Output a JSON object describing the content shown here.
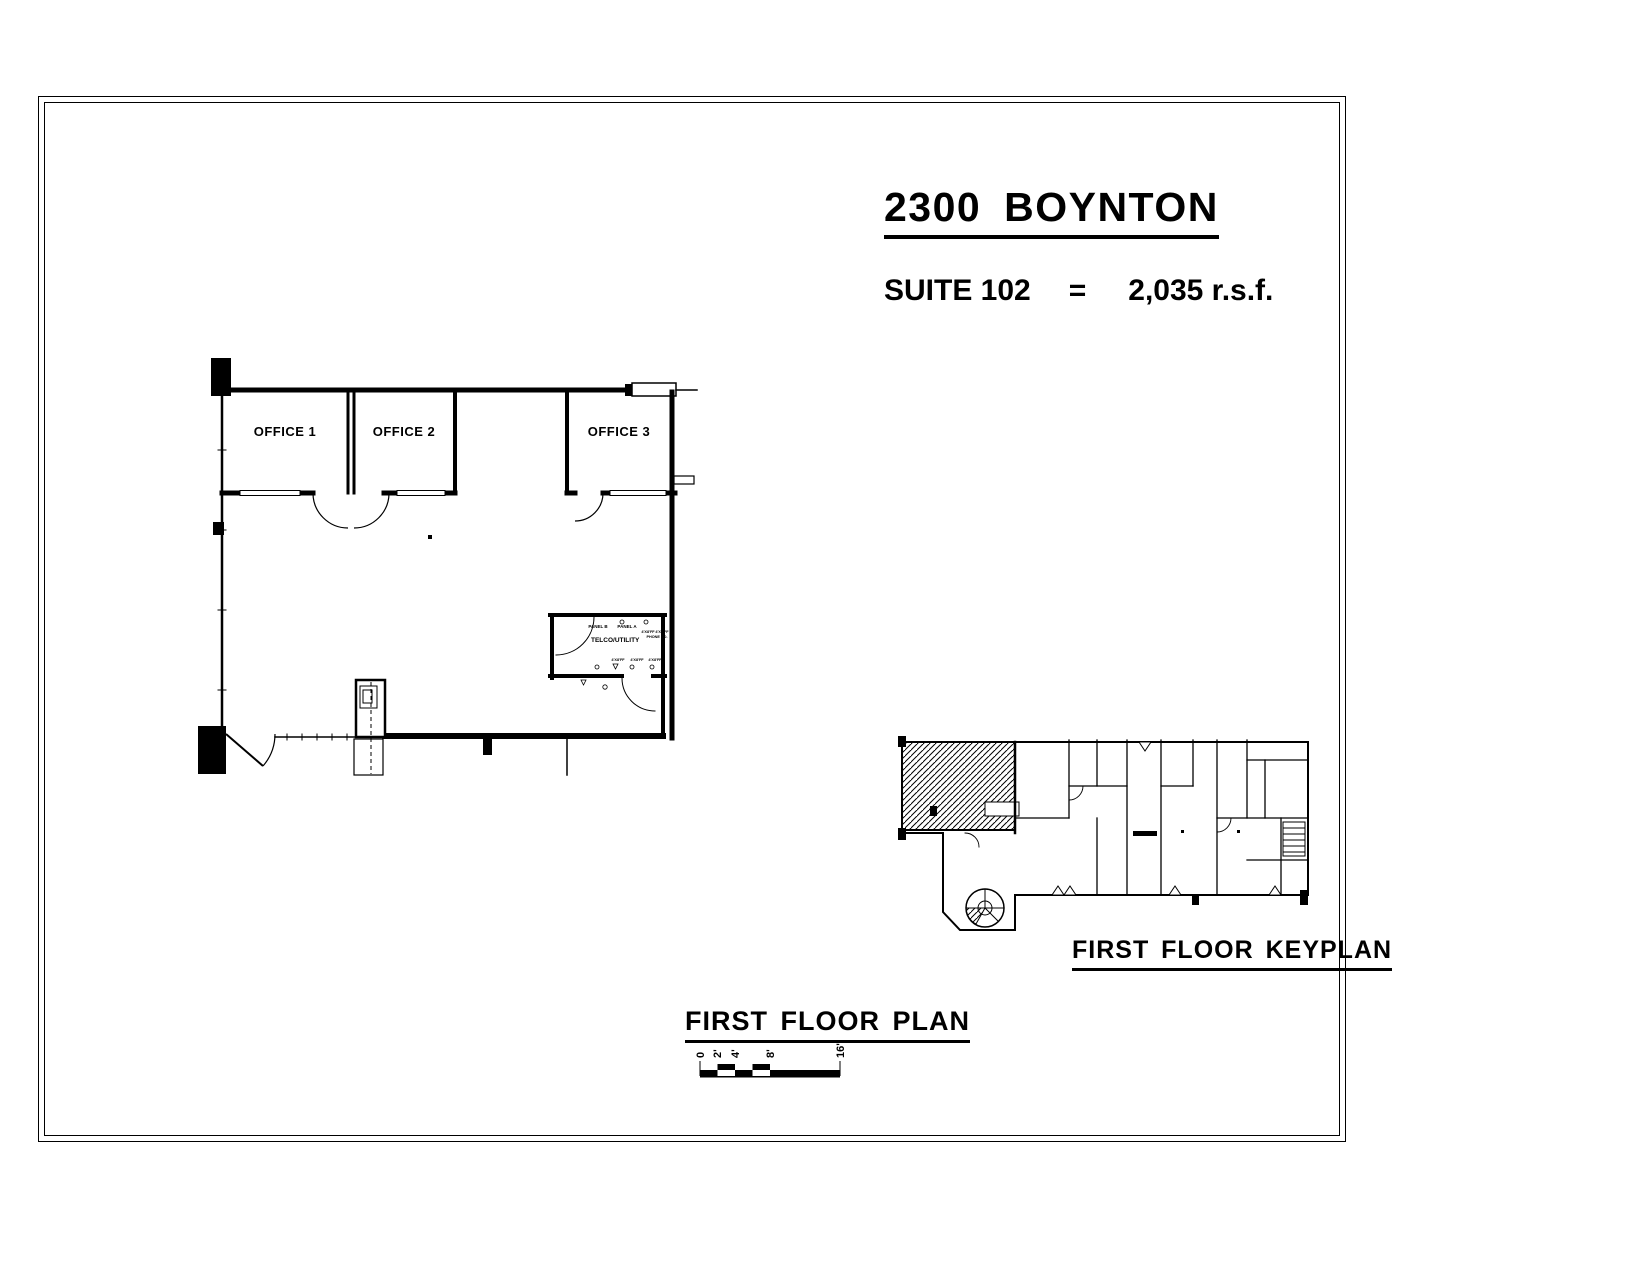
{
  "header": {
    "title": "2300 BOYNTON",
    "suite": "SUITE 102",
    "equals": "=",
    "area": "2,035 r.s.f."
  },
  "floor_plan": {
    "title": "FIRST FLOOR PLAN",
    "office1": "OFFICE 1",
    "office2": "OFFICE 2",
    "office3": "OFFICE 3",
    "telco": {
      "name": "TELCO/UTILITY",
      "panel_b": "PANEL B",
      "panel_a": "PANEL A",
      "phone_board": "PHONE BD.",
      "plywood_note": "4'X8'FF"
    }
  },
  "keyplan": {
    "title": "FIRST FLOOR KEYPLAN"
  },
  "scale_bar": {
    "labels": [
      "0",
      "2'",
      "4'",
      "8'",
      "16'"
    ]
  },
  "colors": {
    "ink": "#000000",
    "paper": "#ffffff"
  }
}
